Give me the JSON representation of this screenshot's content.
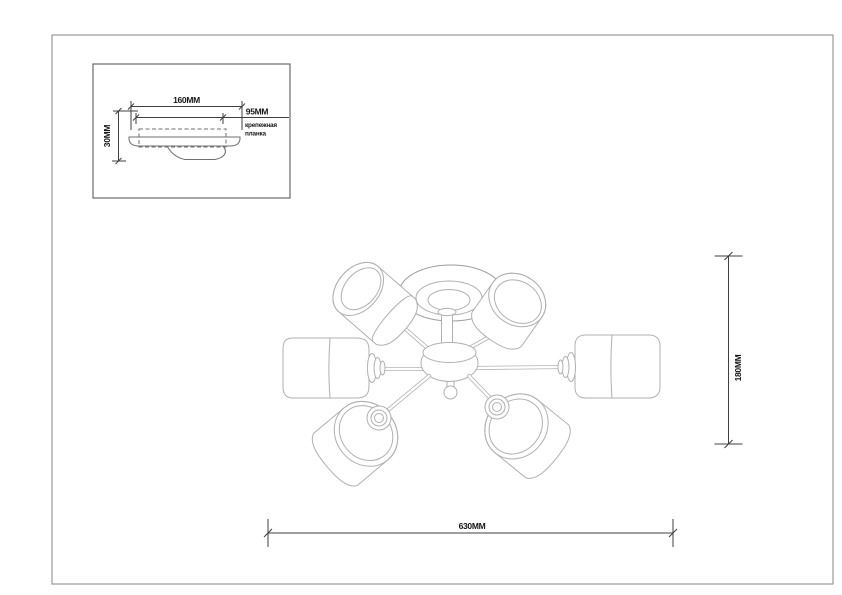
{
  "inset": {
    "width_dim": "160MM",
    "plate_dim": "95MM",
    "plate_label_line1": "крепежная",
    "plate_label_line2": "планка",
    "height_dim": "30MM"
  },
  "main_drawing": {
    "height_dim": "180MM",
    "width_dim": "630MM"
  },
  "colors": {
    "background": "#ffffff",
    "frame_border": "#9a9a9a",
    "inset_border": "#6b6b6b",
    "drawing_line_light": "#b0b0b0",
    "drawing_line_medium": "#6f6f6f",
    "dimension_line": "#3f3f3f",
    "dimension_text": "#161616"
  }
}
